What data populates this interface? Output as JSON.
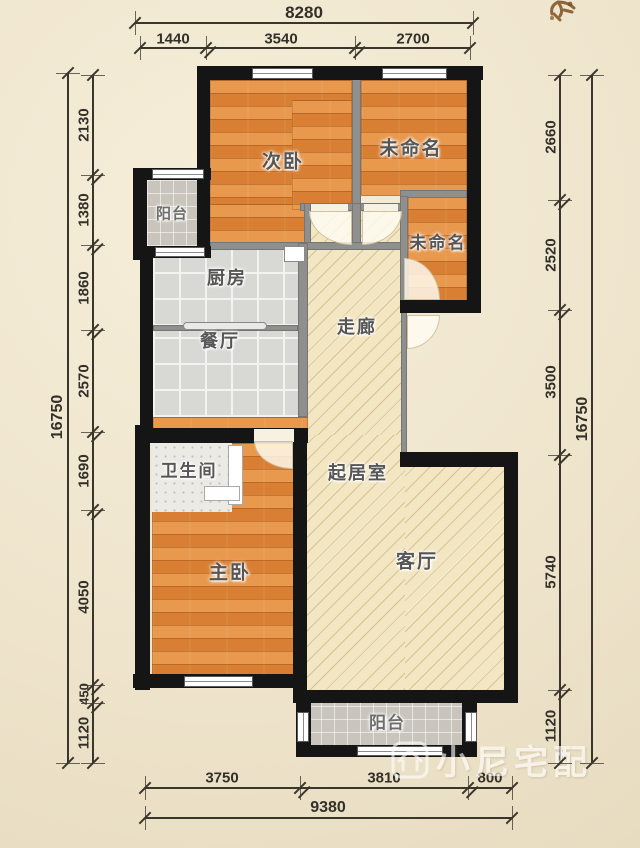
{
  "plan": {
    "rooms": {
      "balcony_top": "阳台",
      "secondary_bedroom": "次卧",
      "unnamed_1": "未命名",
      "unnamed_2": "未命名",
      "kitchen": "厨房",
      "dining": "餐厅",
      "corridor": "走廊",
      "bathroom": "卫生间",
      "living_area": "起居室",
      "master_bedroom": "主卧",
      "living_room": "客厅",
      "balcony_bottom": "阳台"
    },
    "dimensions": {
      "top": {
        "total": "8280",
        "segments": [
          "1440",
          "3540",
          "2700"
        ]
      },
      "left": {
        "total": "16750",
        "segments": [
          "2130",
          "1380",
          "1860",
          "2570",
          "1690",
          "4050",
          "450",
          "1120"
        ]
      },
      "right": {
        "total": "16750",
        "segments": [
          "2660",
          "2520",
          "3500",
          "5740",
          "1120"
        ]
      },
      "bottom": {
        "total": "9380",
        "segments": [
          "3750",
          "3810",
          "800"
        ]
      }
    },
    "colors": {
      "background": "#efe5cd",
      "wood_floor": "#dd8a42",
      "tile_floor": "#d8d8d5",
      "hall_floor": "#f3e6c2",
      "wall": "#151515",
      "partition": "#8f8f8d",
      "dimension": "#3a362c"
    },
    "watermark": {
      "text": "小尼宅配",
      "logo": "house-logo"
    }
  }
}
